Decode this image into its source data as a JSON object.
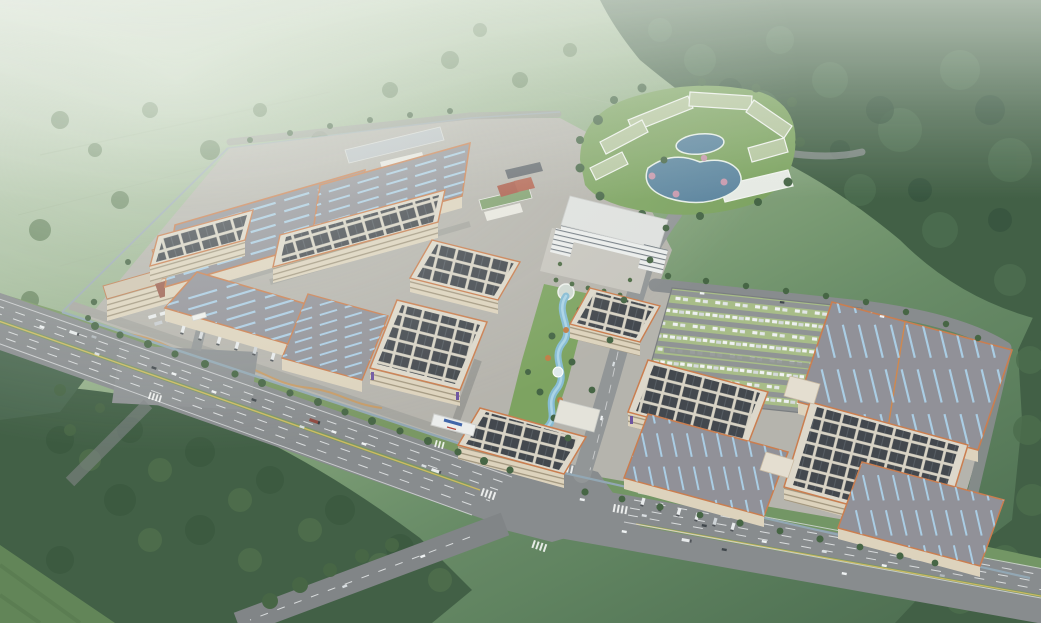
{
  "scene": {
    "type": "architectural-aerial-rendering",
    "title": "Industrial park master plan — bird's-eye rendering",
    "description": "Photorealistic aerial render of a large logistics and manufacturing campus set in hazy green hills. Rows of grey-roofed warehouses with blue skylight strips and orange eave trim, multi-storey flatted factories with dark rooftop solar arrays, a central landscaped strip with a winding blue stream, a white headquarters block with entry plaza, a resort-style staff campus with ponds at the north-east, a large grass-paver parking lot, truck loading docks, and a wide highway with a signalised intersection crossing the foreground. Dense dark forest frames the right and lower-left edges; misty farmland fades out at the top-left.",
    "regions": [
      {
        "id": "background-hills",
        "label": "Misty green hills and farmland"
      },
      {
        "id": "forest-northeast",
        "label": "Dark forested hillside (top right)"
      },
      {
        "id": "forest-southwest",
        "label": "Dense tree belt (bottom left)"
      },
      {
        "id": "campus-plate",
        "label": "Industrial campus ground plate"
      },
      {
        "id": "warehouse-blocks",
        "label": "Grey-roof warehouses with blue skylights"
      },
      {
        "id": "solar-factories",
        "label": "Flatted factories with rooftop solar panels"
      },
      {
        "id": "garden-stream",
        "label": "Central landscaped strip with winding stream"
      },
      {
        "id": "hq-building",
        "label": "White headquarters building and plaza"
      },
      {
        "id": "resort-campus",
        "label": "Staff resort campus with twin ponds"
      },
      {
        "id": "parking-lot",
        "label": "Grass-paver car parking lot"
      },
      {
        "id": "dormitory",
        "label": "L-shaped dormitory block"
      },
      {
        "id": "highway",
        "label": "Multi-lane highway with intersection"
      },
      {
        "id": "campus-gate",
        "label": "White campus gate with blue sign"
      }
    ],
    "counts": {
      "grey_roof_warehouses": 7,
      "solar_roof_factories": 8,
      "resort_buildings": 7,
      "ponds": 2,
      "parking_lots": 1,
      "dock_truck_groups": 5,
      "road_intersections": 2
    }
  },
  "palette": {
    "haze_white": "#eef3ec",
    "field_light": "#c8d3c3",
    "field_mid": "#8aa77f",
    "field_dark": "#4a6c4e",
    "forest_dark": "#3c5a40",
    "forest_deep": "#2f4d38",
    "forest_lit": "#4d6f4b",
    "road_asphalt": "#85888b",
    "road_minor": "#8f9294",
    "lane_white": "#d9dbdd",
    "lane_yellow": "#cdb85c",
    "median_green": "#76945f",
    "concrete_plate": "#b4b1ab",
    "perimeter_road": "#a3a29d",
    "roof_grey": "#8e8d95",
    "skylight_blue": "#a8cbe4",
    "trim_orange": "#c9794a",
    "wall_beige": "#ddd2bc",
    "wall_shadow": "#a89a81",
    "roof_border": "#dcd6c9",
    "solar_dark": "#3d4148",
    "water_pond": "#56809c",
    "water_stream": "#84bad4",
    "stream_core": "#a9d3e6",
    "lawn_green": "#79a05c",
    "parking_green": "#a6bb85",
    "building_white": "#eceded",
    "hq_band": "#707880",
    "resort_roof": "#b3c49c",
    "blossom_pink": "#c594aa",
    "tree_green": "#41603f",
    "tree_orange": "#c07840",
    "truck_white": "#e9ebed",
    "truck_dark": "#4a4e54",
    "courtyard_red": "#9a594a",
    "court_red": "#a85342",
    "boundary_wall": "#8fa4b2",
    "ribbon_tan": "#c8965c",
    "sign_blue": "#3a5fa8"
  }
}
